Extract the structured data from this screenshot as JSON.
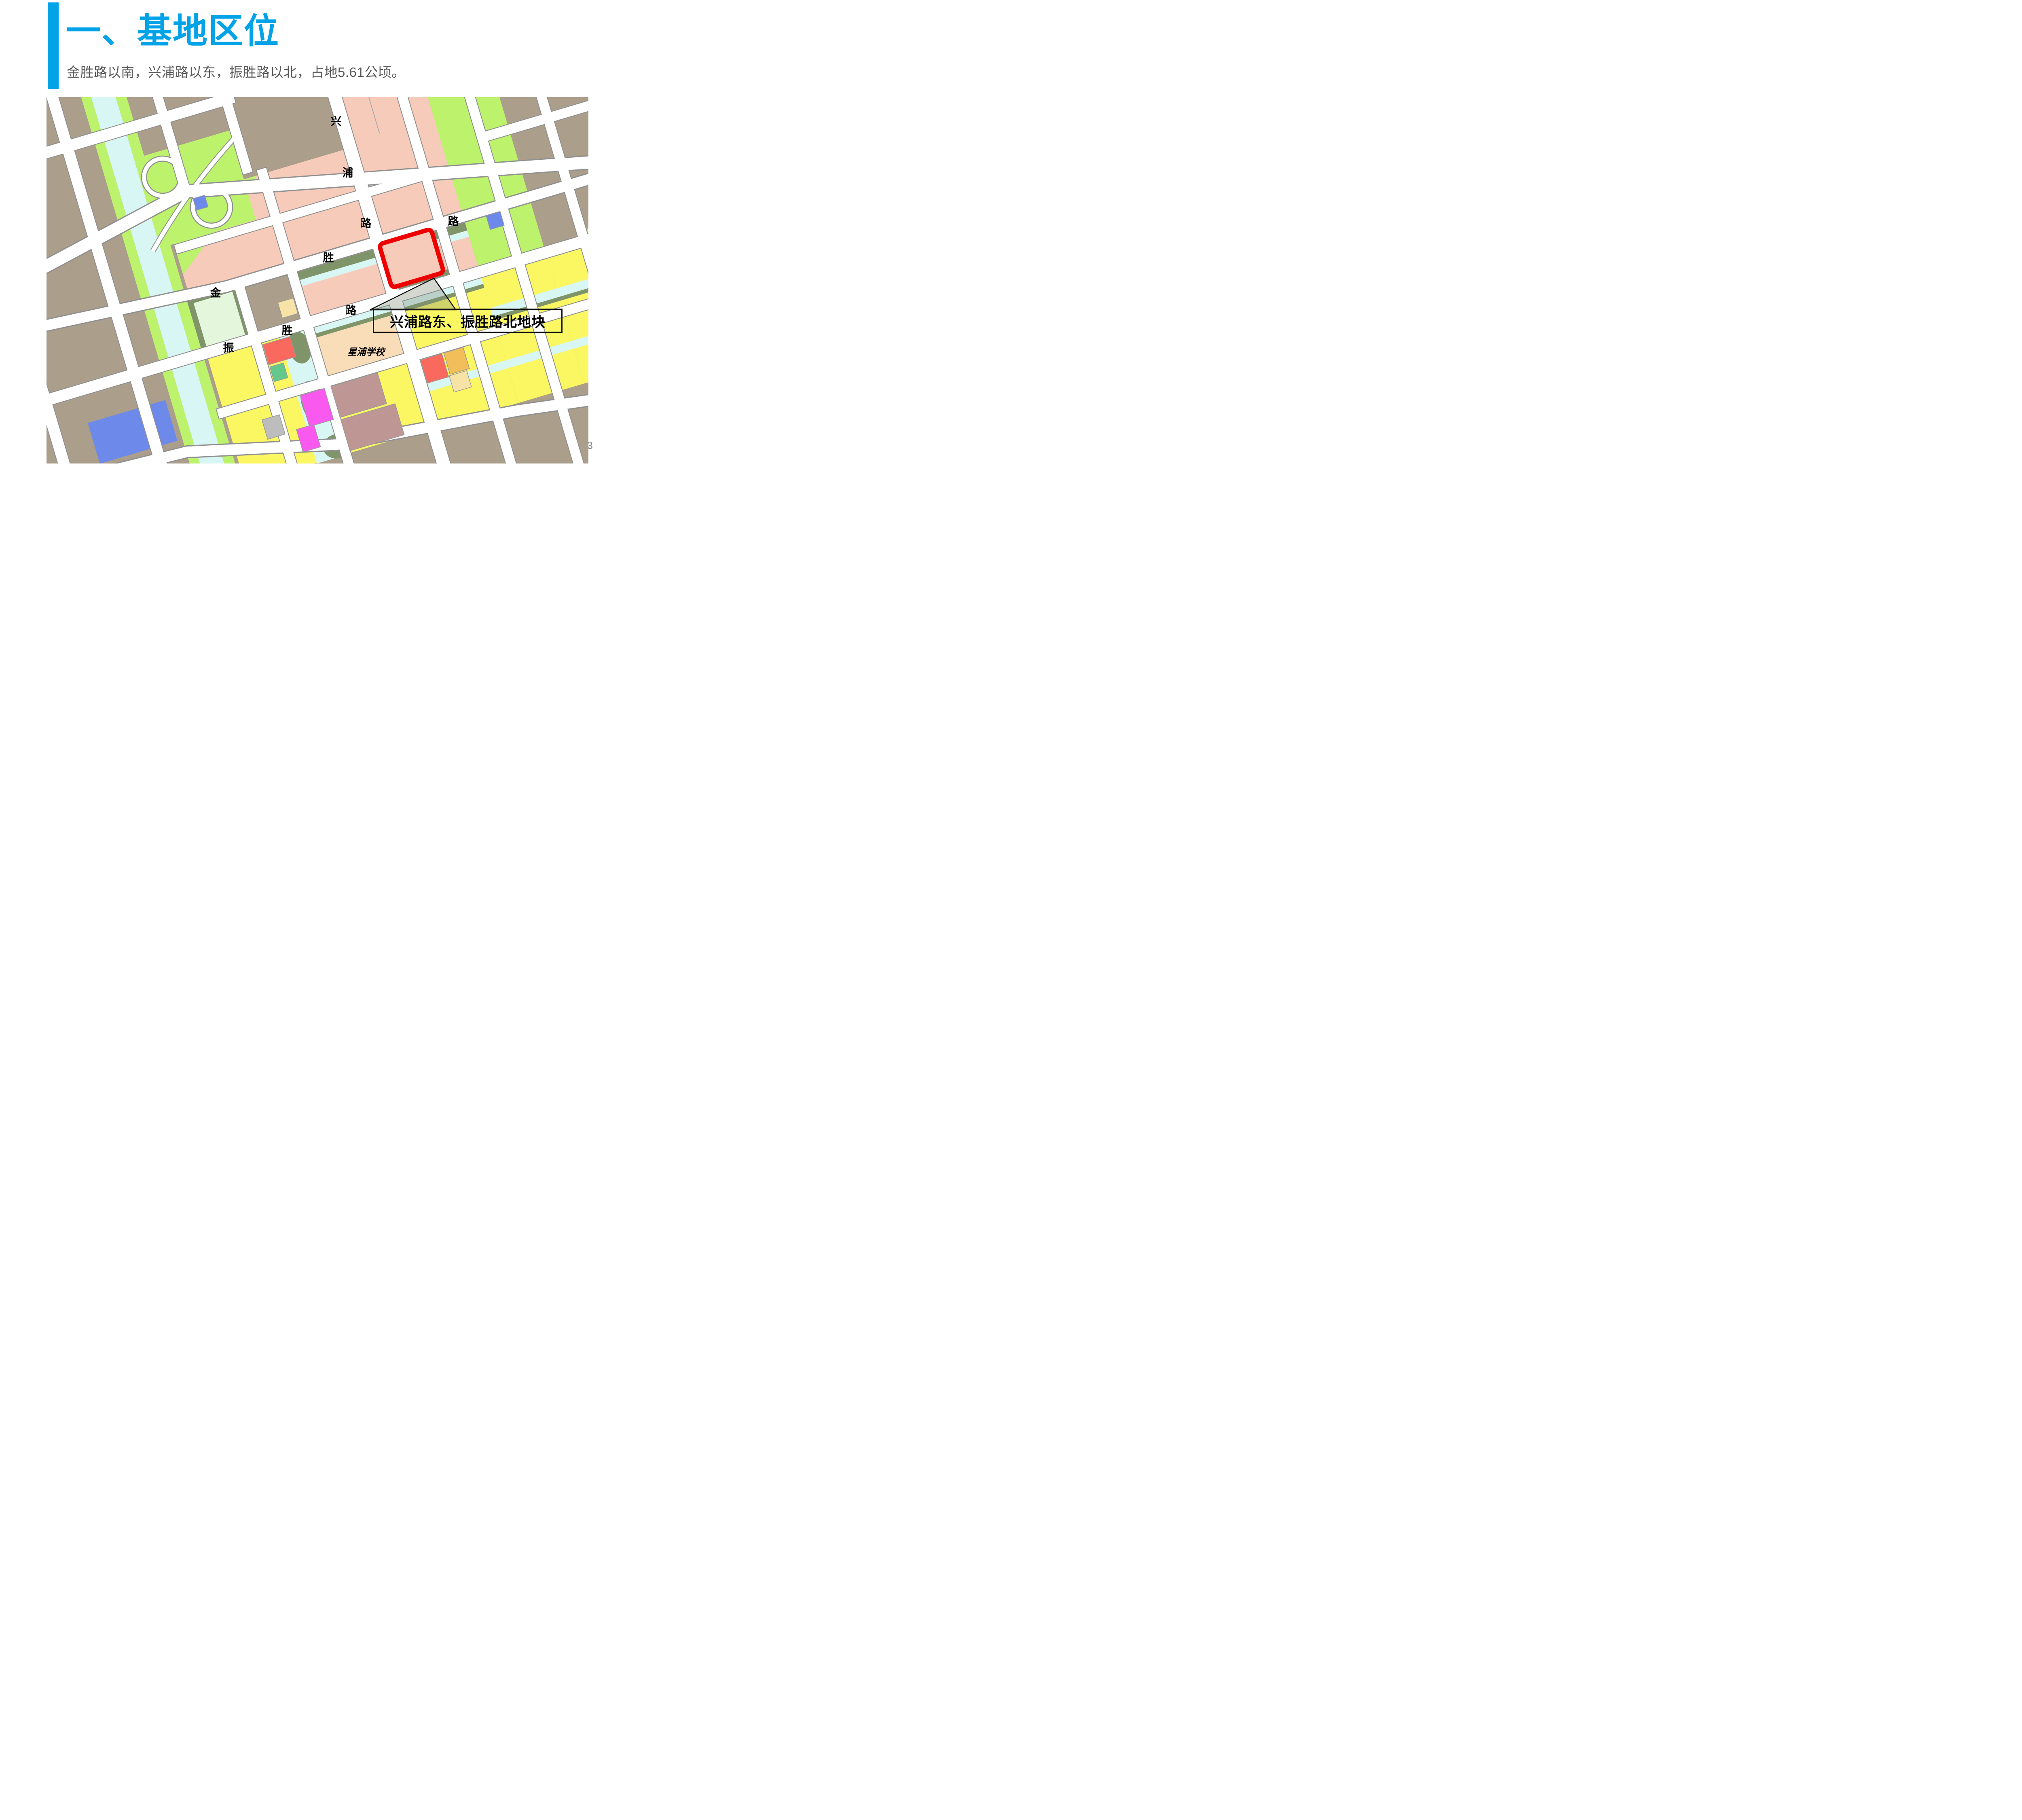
{
  "slide": {
    "title": "一、基地区位",
    "subtitle": "金胜路以南，兴浦路以东，振胜路以北，占地5.61公顷。",
    "page_number": "3"
  },
  "map": {
    "road_labels": [
      {
        "id": "xingpu-road-char-1",
        "text": "兴"
      },
      {
        "id": "xingpu-road-char-2",
        "text": "浦"
      },
      {
        "id": "xingpu-road-char-3",
        "text": "路"
      },
      {
        "id": "jinsheng-road-char-1",
        "text": "金"
      },
      {
        "id": "jinsheng-road-char-2",
        "text": "胜"
      },
      {
        "id": "jinsheng-road-char-3",
        "text": "路"
      },
      {
        "id": "zhensheng-road-char-1",
        "text": "振"
      },
      {
        "id": "zhensheng-road-char-2",
        "text": "胜"
      },
      {
        "id": "zhensheng-road-char-3",
        "text": "路"
      }
    ],
    "school_label": "星浦学校",
    "callout_text": "兴浦路东、振胜路北地块"
  },
  "colors": {
    "accent": "#00A2E8",
    "subtitle-gray": "#595959",
    "pagenum-gray": "#8C8C8C",
    "road-stroke": "#909090",
    "taupe": "#AB9E8B",
    "salmon": "#F7CBBA",
    "green": "#BDF26D",
    "cyan": "#D8F6F4",
    "olive": "#7F9569",
    "yellow": "#FAF763",
    "mint": "#E4F6DC",
    "peach": "#F9DCB8",
    "red-block": "#F9695E",
    "blue-block": "#6D89E9",
    "magenta": "#F959EF",
    "orange": "#F2BE5A",
    "pale-orange": "#F8E3A6",
    "gray-block": "#BDBDBD",
    "mauve": "#BE9795",
    "mid-green": "#64C88C",
    "plot-red": "#EE0000",
    "callout-border": "#111111"
  }
}
